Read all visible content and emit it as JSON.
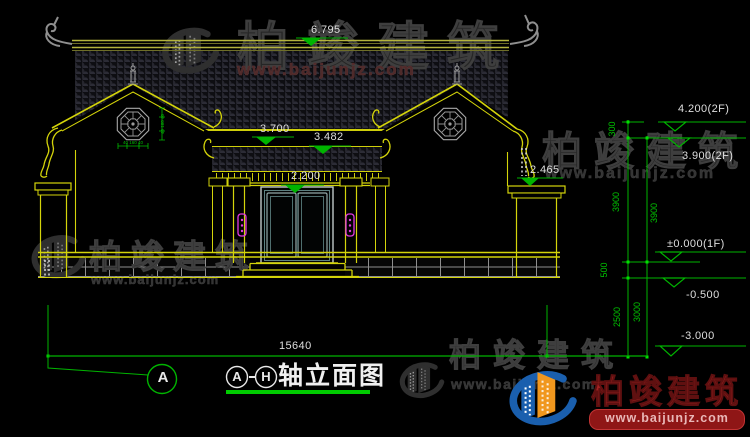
{
  "watermark": {
    "brand": "柏竣建筑",
    "url": "www.baijunjz.com"
  },
  "logo": {
    "brand": "柏竣建筑",
    "url": "www.baijunjz.com"
  },
  "title_block": {
    "axis_start": "A",
    "axis_end": "H",
    "name": "轴立面图"
  },
  "axis_bubble": {
    "label": "A"
  },
  "dimensions": {
    "overall_width": "15640",
    "ridge_level": "6.795",
    "main_eave_level": "3.700",
    "porch_eave_level": "3.482",
    "door_level": "2.200",
    "gable_eave_level": "2.465",
    "right_levels": [
      {
        "label": "4.200(2F)"
      },
      {
        "label": "3.900(2F)"
      },
      {
        "label": "±0.000(1F)"
      },
      {
        "label": "-0.500"
      },
      {
        "label": "-3.000"
      }
    ],
    "outer_chain": [
      {
        "v": "300"
      },
      {
        "v": "3900"
      },
      {
        "v": "500"
      },
      {
        "v": "2500"
      }
    ],
    "inner_chain": [
      {
        "v": "3900"
      },
      {
        "v": "3000"
      }
    ],
    "ornament_width": "40 160 40",
    "ornament_height": "40 160 40"
  },
  "colors": {
    "background": "#000000",
    "cad_yellow": "#d4d40a",
    "dim_green": "#00b400",
    "text_white": "#dedede",
    "lamp_magenta": "#e23ae2",
    "logo_red": "#a32222",
    "logo_blue": "#1a5fae",
    "logo_orange": "#f0971e"
  }
}
